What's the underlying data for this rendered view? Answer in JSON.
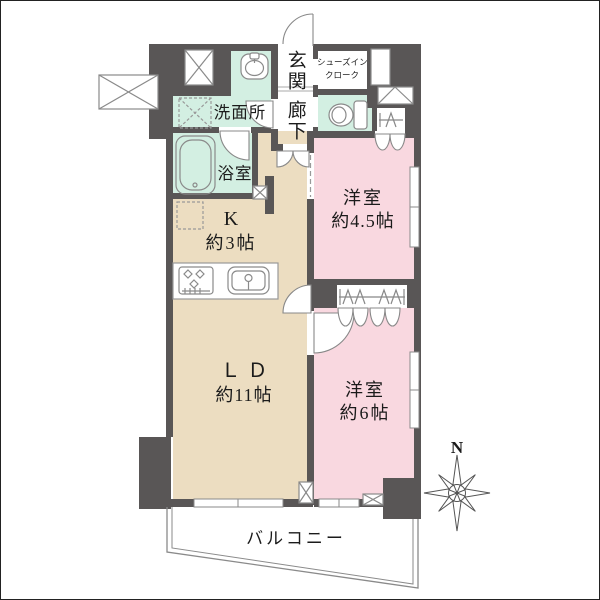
{
  "floorplan": {
    "rooms": {
      "entrance": {
        "label": "玄関"
      },
      "hallway": {
        "label": "廊下"
      },
      "shoes_in_closet": {
        "label_line1": "シューズイン",
        "label_line2": "クローク"
      },
      "washroom": {
        "label": "洗面所"
      },
      "bathroom": {
        "label": "浴室"
      },
      "kitchen": {
        "label": "K",
        "size": "約3帖"
      },
      "living_dining": {
        "label": "ＬＤ",
        "size": "約11帖"
      },
      "bedroom_1": {
        "label": "洋室",
        "size": "約4.5帖"
      },
      "bedroom_2": {
        "label": "洋室",
        "size": "約6帖"
      },
      "balcony": {
        "label": "バルコニー"
      }
    },
    "compass": {
      "north_label": "N"
    },
    "colors": {
      "wall_gray": "#595656",
      "mint_green": "#d3efe2",
      "beige": "#ecddc1",
      "pink": "#f9d8e0",
      "outline_gray": "#8a8a8a"
    }
  }
}
